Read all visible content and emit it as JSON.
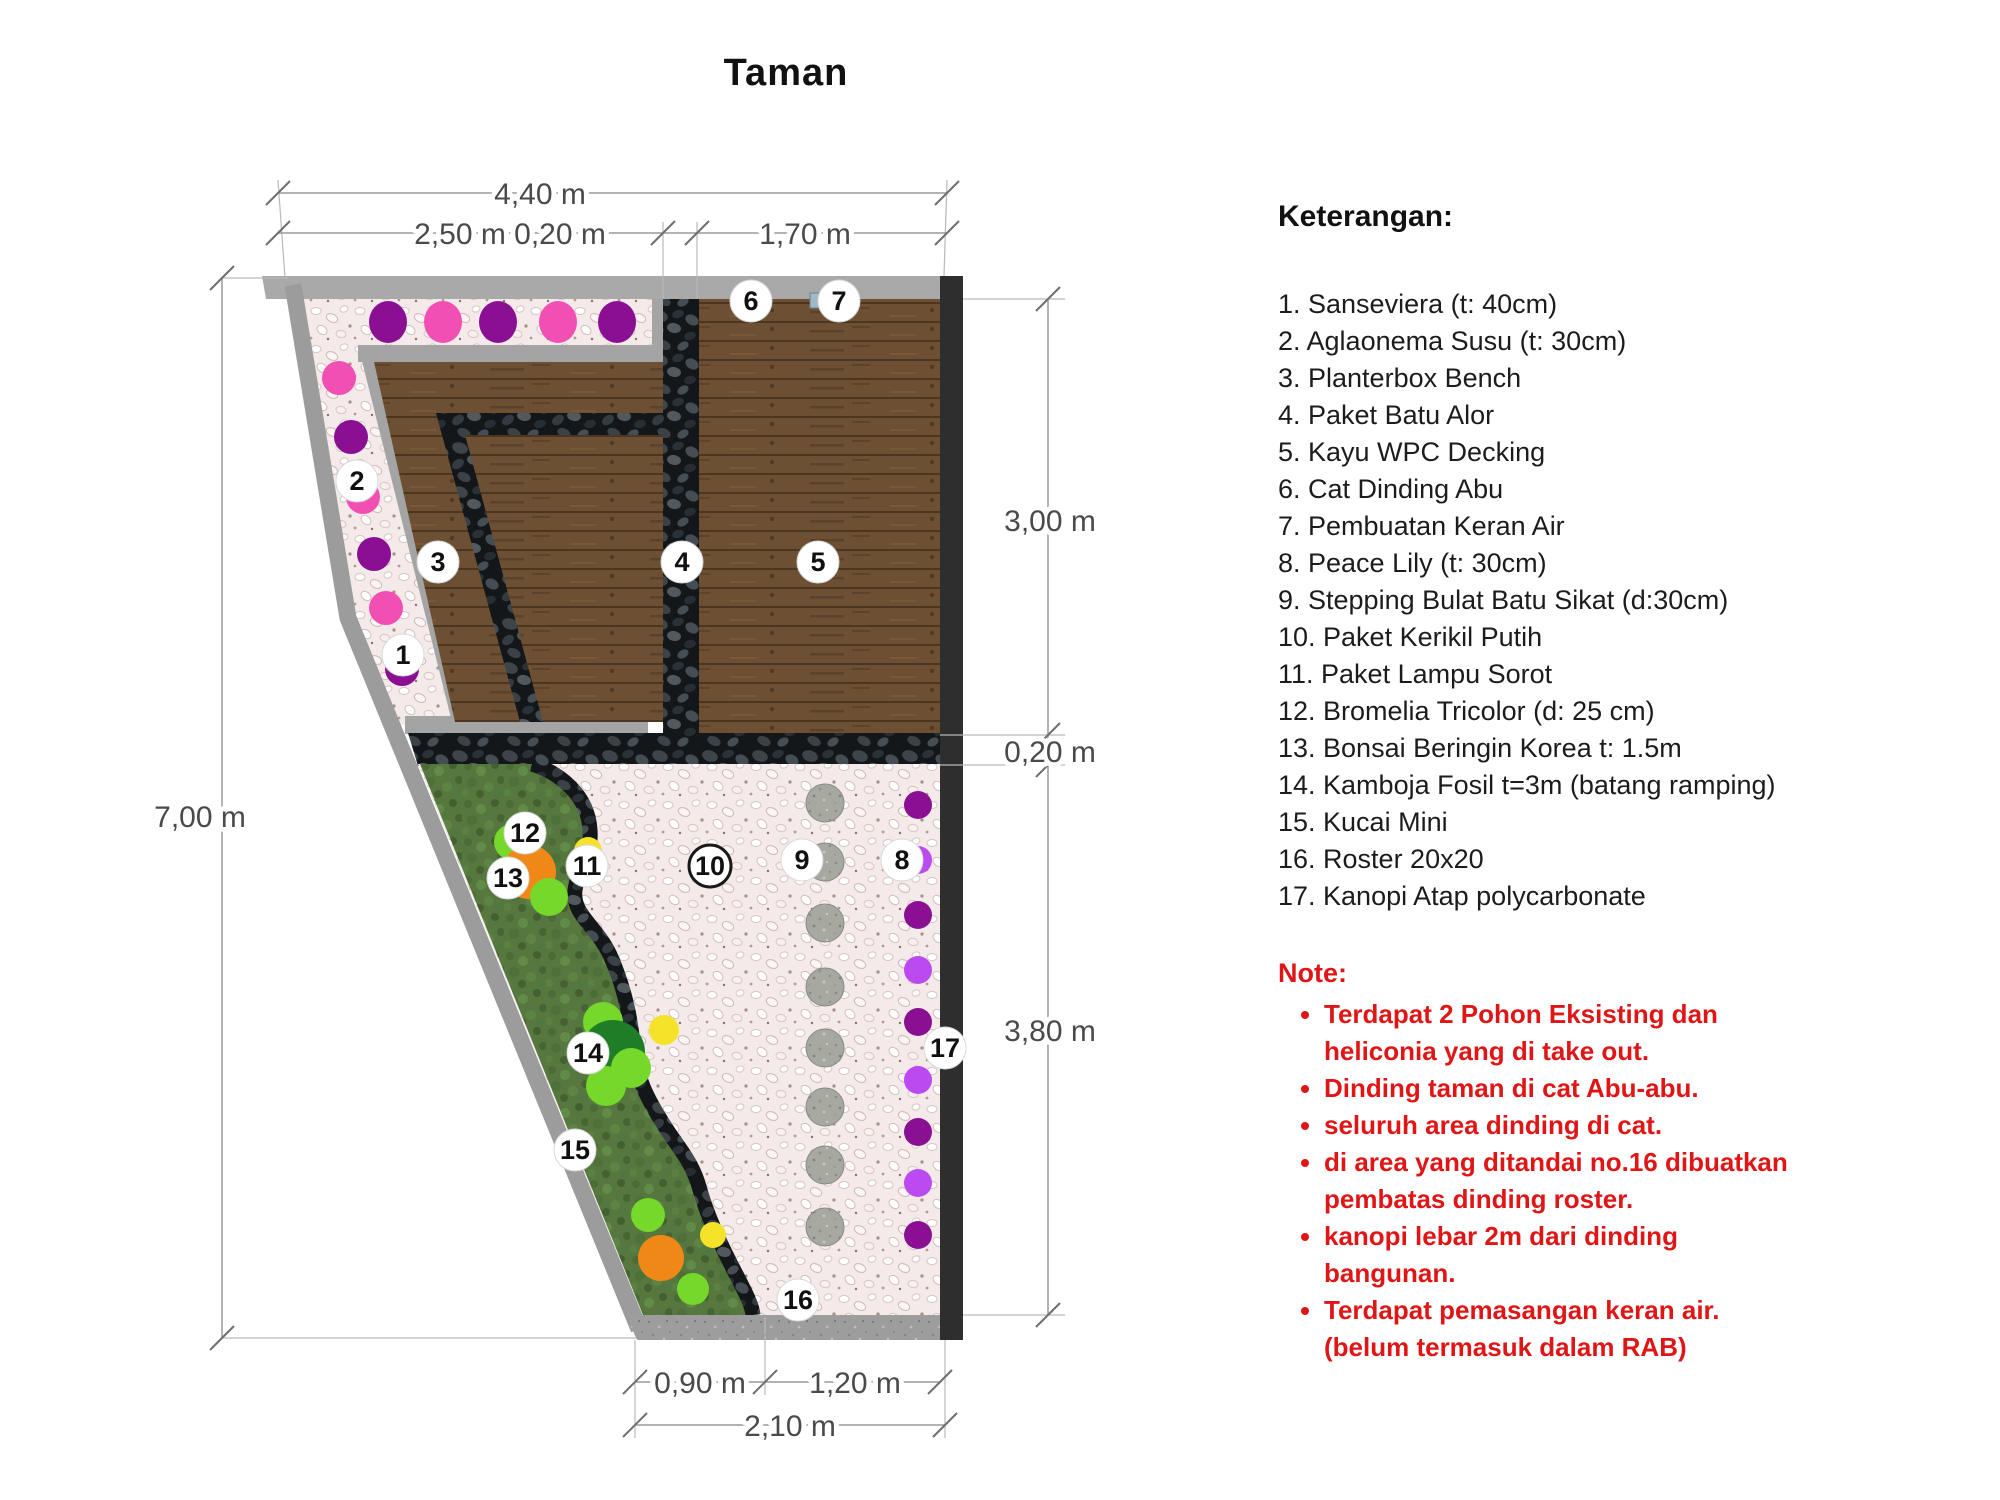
{
  "title": "Taman",
  "legend": {
    "heading": "Keterangan:",
    "items": [
      "1. Sanseviera (t: 40cm)",
      "2. Aglaonema Susu (t: 30cm)",
      "3. Planterbox Bench",
      "4. Paket Batu Alor",
      "5. Kayu WPC Decking",
      "6. Cat Dinding Abu",
      "7. Pembuatan Keran Air",
      "8. Peace Lily (t: 30cm)",
      "9. Stepping Bulat Batu Sikat (d:30cm)",
      "10. Paket Kerikil Putih",
      "11. Paket Lampu Sorot",
      "12. Bromelia Tricolor (d: 25 cm)",
      "13. Bonsai Beringin Korea t: 1.5m",
      "14. Kamboja Fosil t=3m (batang ramping)",
      "15. Kucai Mini",
      "16. Roster 20x20",
      "17. Kanopi Atap polycarbonate"
    ]
  },
  "note": {
    "heading": "Note:",
    "bullets": [
      "Terdapat 2 Pohon Eksisting dan heliconia yang di take out.",
      "Dinding taman di cat Abu-abu.",
      "seluruh area dinding di cat.",
      "di area yang ditandai no.16 dibuatkan pembatas dinding roster.",
      "kanopi lebar 2m dari dinding bangunan.",
      "Terdapat pemasangan keran air. (belum termasuk dalam RAB)"
    ]
  },
  "plan": {
    "dimensions": {
      "top_total": "4,40 m",
      "top_a": "2,50 m",
      "top_b": "0,20 m",
      "top_c": "1,70 m",
      "left": "7,00 m",
      "right_a": "3,00 m",
      "right_b": "0,20 m",
      "right_c": "3,80 m",
      "bottom_a": "0,90 m",
      "bottom_b": "1,20 m",
      "bottom_total": "2,10 m"
    },
    "markers": [
      {
        "n": "1"
      },
      {
        "n": "2"
      },
      {
        "n": "3"
      },
      {
        "n": "4"
      },
      {
        "n": "5"
      },
      {
        "n": "6"
      },
      {
        "n": "7"
      },
      {
        "n": "8"
      },
      {
        "n": "9"
      },
      {
        "n": "10"
      },
      {
        "n": "11"
      },
      {
        "n": "12"
      },
      {
        "n": "13"
      },
      {
        "n": "14"
      },
      {
        "n": "15"
      },
      {
        "n": "16"
      },
      {
        "n": "17"
      }
    ],
    "colors": {
      "note_red": "#E01616",
      "wall_gray": "#A6A6A6",
      "building_wall_dark": "#2E2E2E",
      "wood_decking": "#6D5033",
      "batu_alor_dark": "#15181B",
      "kerikil_putih": "#F2E9E8",
      "grass_green": "#57793F",
      "stepping_stone": "#A9ABA3",
      "plant_pink": "#F24FB3",
      "plant_purple": "#8A0F92",
      "plant_violet": "#BB4AF0",
      "plant_orange": "#F08818",
      "plant_lightgreen": "#76D82A",
      "plant_darkgreen": "#1E7D26",
      "lamp_yellow": "#F5E32A",
      "keran_air_blue": "#9FB9C9"
    }
  }
}
